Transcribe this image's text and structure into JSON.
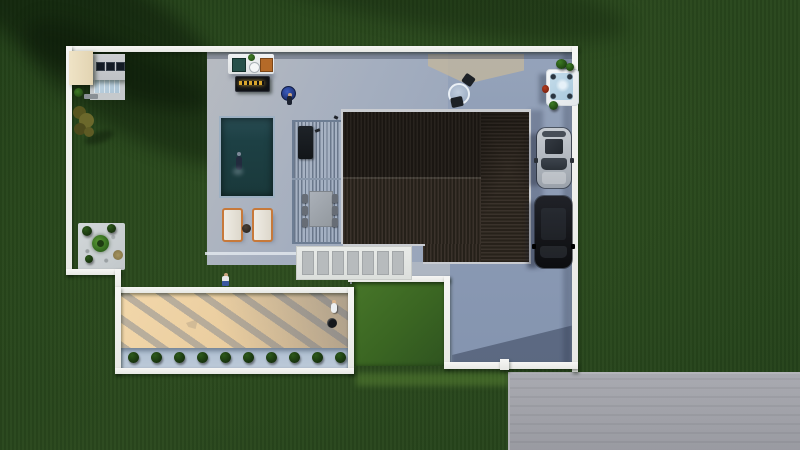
{
  "scene": {
    "type": "aerial-3d-render",
    "description": "Top-down 3D architectural rendering of a walled residential lot: modern house with dark brown ribbed roof, slatted pergola with dining set and grill, rectangular pool with swimmer, two sun loungers, outdoor kitchen and lit bar counter, hot tub with plants, driveway with two parked cars, sand play court with pergola shadows and planter hedge, corner rock garden with palm, shed with skylights, and a grey street at lower right surrounded by dark green lawn."
  },
  "palette": {
    "grass": "#2a481d",
    "grass_shadow": "#16270f",
    "concrete_patio": "#a4aebf",
    "driveway": "#8a99b3",
    "road": "#9fa0a7",
    "roof_dark": "#252019",
    "roof_brown": "#3a322b",
    "pool_water": "#1d4044",
    "sand": "#e8cb9d",
    "wall_white": "#f1f2ef",
    "hot_tub_water": "#b7d3e4",
    "car_silver": "#b9bfc7",
    "car_black": "#16171b",
    "lounger_frame": "#c7793a",
    "bar_sign_gold": "#d9a62e",
    "round_table_blue": "#27418f",
    "planter_bush_green": "#1d3a12"
  },
  "counts": {
    "stepping_stones": 7,
    "planter_bushes": 10,
    "parked_cars": 2,
    "sun_loungers": 2,
    "dining_chairs": 6,
    "shed_skylights": 3,
    "people": 5
  },
  "objects": {
    "house_roof": "gabled ribbed roof, dark upper slope and brown lower slope with hipped right wing",
    "pergola": "slatted cover over grill and six-seat dining table",
    "pool": "dark teal rectangular pool with one swimmer",
    "hot_tub": "white square jacuzzi with light blue water",
    "sand_court": "tan court with diagonal pergola shadows and two players",
    "cars": "silver hatchback and black SUV parked nose-down",
    "bar": "dark counter with glowing gold sign",
    "outdoor_kitchen": "white island with grill, sink and orange cabinet",
    "shed": "flat-roof shed with cream awning and three skylights",
    "garden": "corner gravel bed with palm and shrubs",
    "street": "grey concrete road at lower right"
  }
}
